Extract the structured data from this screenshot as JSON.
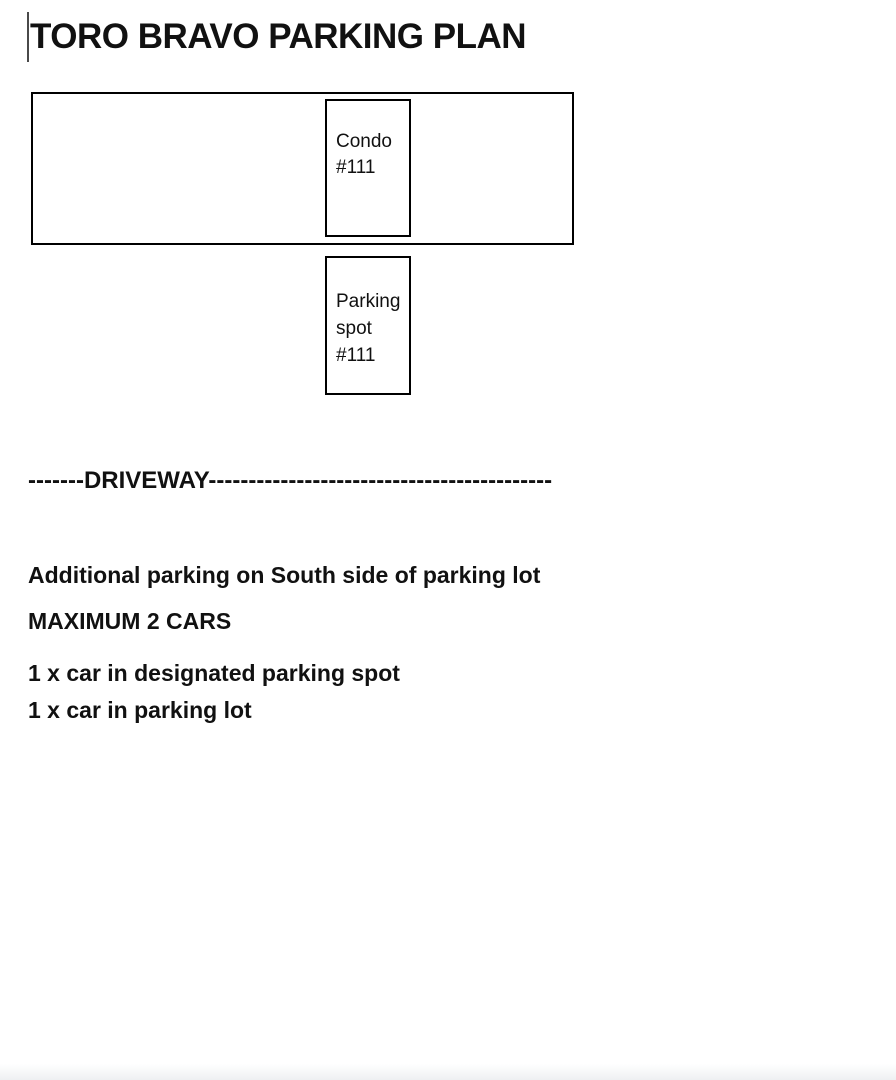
{
  "title": "TORO BRAVO PARKING PLAN",
  "diagram": {
    "condo_box": {
      "lines": [
        "Condo",
        "#111"
      ]
    },
    "parking_spot_box": {
      "lines": [
        "Parking",
        "spot",
        "#111"
      ]
    }
  },
  "driveway_label": "-------DRIVEWAY-------------------------------------------",
  "notes": [
    "Additional parking on South side of parking lot",
    "MAXIMUM 2 CARS",
    "1 x car in designated parking spot",
    "1 x car in parking lot"
  ],
  "colors": {
    "text": "#111111",
    "box_border": "#000000",
    "background": "#ffffff"
  }
}
